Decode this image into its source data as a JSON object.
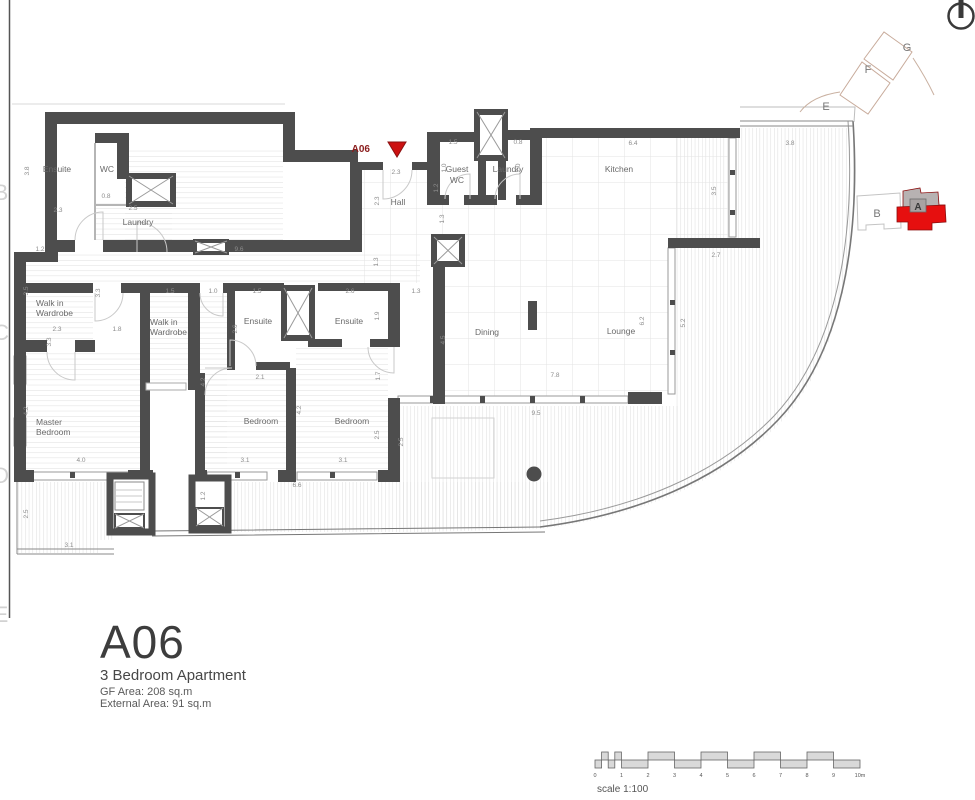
{
  "marker": {
    "label": "A06"
  },
  "title_block": {
    "unit": "A06",
    "subtitle": "3 Bedroom Apartment",
    "gf_area": "GF Area: 208 sq.m",
    "external_area": "External Area: 91 sq.m"
  },
  "room_labels": [
    "Ensuite",
    "WC",
    "Laundry",
    "Walk in",
    "Wardrobe",
    "Walk in",
    "Wardrobe",
    "Ensuite",
    "Ensuite",
    "Hall",
    "Guest",
    "WC",
    "Laundry",
    "Kitchen",
    "Dining",
    "Lounge",
    "Master",
    "Bedroom",
    "Bedroom",
    "Bedroom"
  ],
  "dims": [
    "3.8",
    "2.3",
    "0.8",
    "2.5",
    "1.2",
    "9.6",
    "1.3",
    "3.5",
    "3.3",
    "1.5",
    "1.0",
    "2.3",
    "1.8",
    "3.3",
    "1.5",
    "2.6",
    "1.3",
    "2.6",
    "1.9",
    "2.1",
    "1.7",
    "4.2",
    "4.2",
    "2.5",
    "2.5",
    "4.5",
    "3.1",
    "3.1",
    "6.6",
    "4.0",
    "4.2",
    "2.5",
    "3.1",
    "1.2",
    "2.3",
    "2.3",
    "1.3",
    "1.2",
    "1.5",
    "0.8",
    "1.0",
    "2.0",
    "6.4",
    "3.8",
    "3.5",
    "2.7",
    "5.2",
    "6.2",
    "7.8",
    "9.5"
  ],
  "key_plan": {
    "letters": [
      "E",
      "F",
      "G",
      "B",
      "A"
    ],
    "highlighted_unit": "A",
    "colors": {
      "highlight_red": "#e60f0f",
      "muted_gray": "#b7b2b2"
    }
  },
  "grid_letters": [
    "B",
    "C",
    "D",
    "E"
  ],
  "scale_bar": {
    "label": "scale 1:100",
    "ticks": [
      "0",
      "1",
      "2",
      "3",
      "4",
      "5",
      "6",
      "7",
      "8",
      "9",
      "10m"
    ]
  }
}
